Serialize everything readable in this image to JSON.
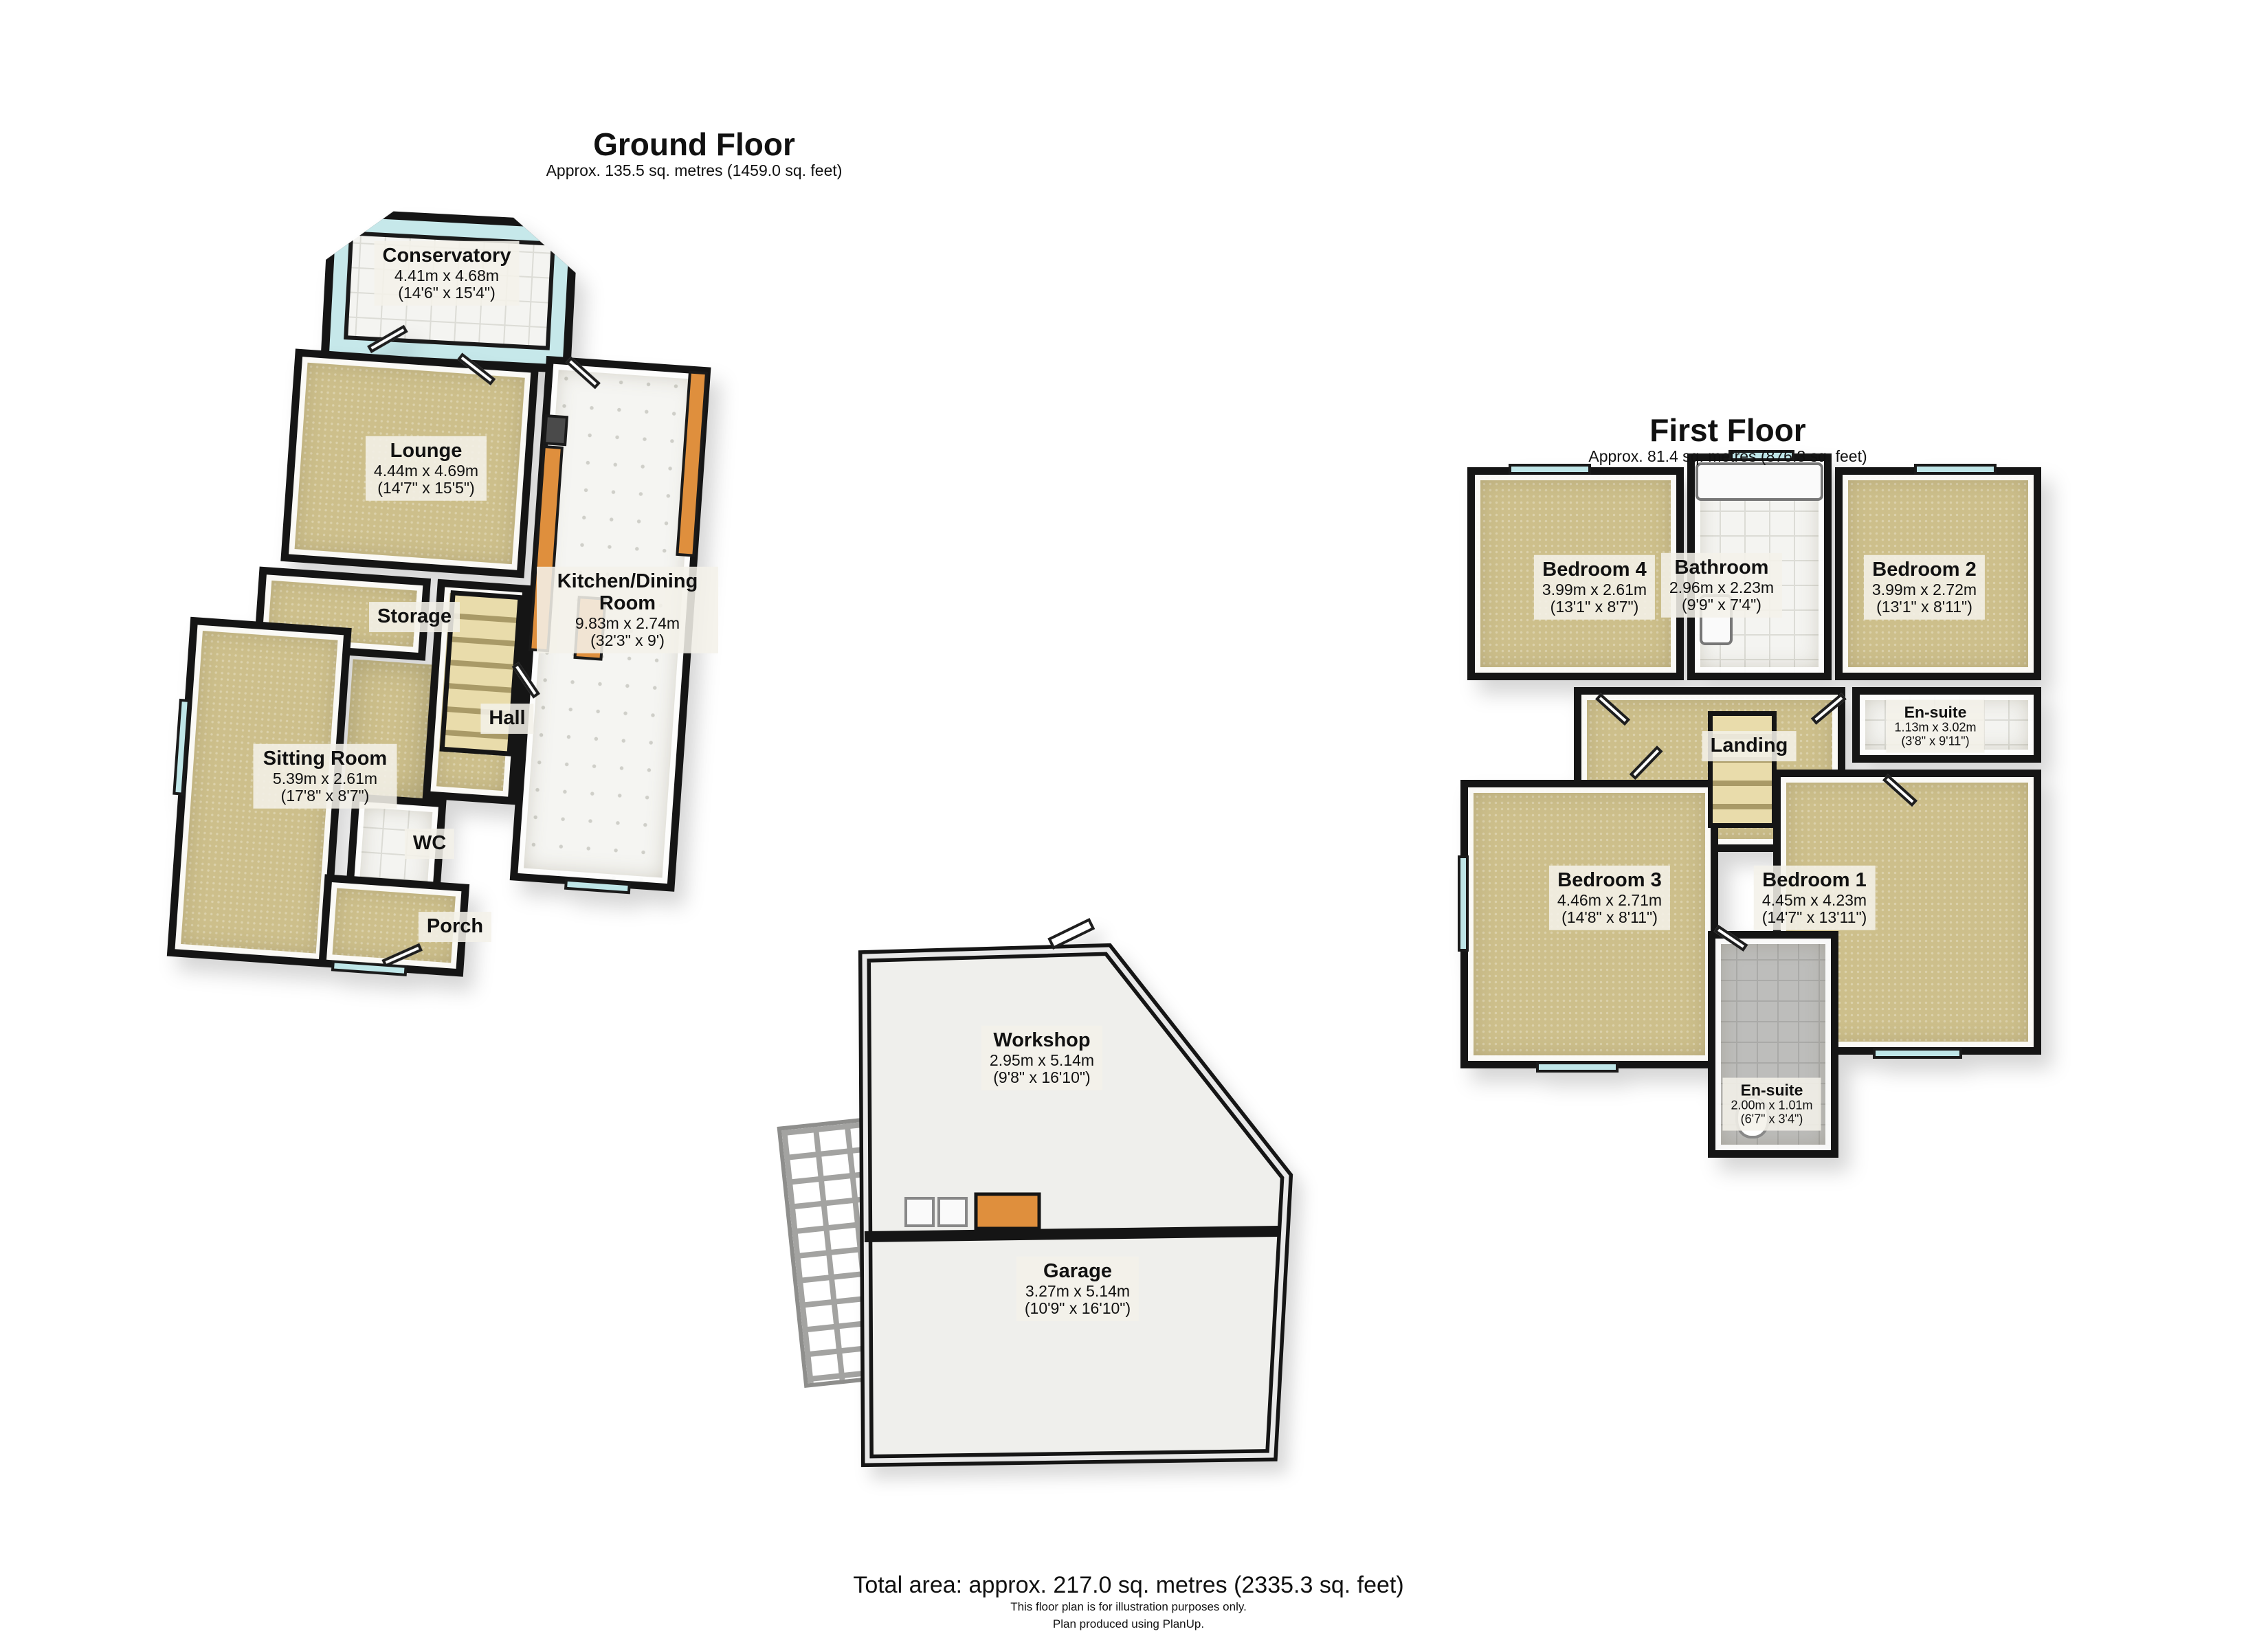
{
  "ground_floor": {
    "title": "Ground Floor",
    "subtitle": "Approx. 135.5 sq. metres (1459.0 sq. feet)",
    "rooms": {
      "conservatory": {
        "name": "Conservatory",
        "dims_m": "4.41m x 4.68m",
        "dims_ft": "(14'6\" x 15'4\")"
      },
      "lounge": {
        "name": "Lounge",
        "dims_m": "4.44m x 4.69m",
        "dims_ft": "(14'7\" x 15'5\")"
      },
      "kitchen": {
        "name": "Kitchen/Dining Room",
        "dims_m": "9.83m x 2.74m",
        "dims_ft": "(32'3\" x 9')"
      },
      "storage": {
        "name": "Storage"
      },
      "hall": {
        "name": "Hall"
      },
      "sitting": {
        "name": "Sitting Room",
        "dims_m": "5.39m x 2.61m",
        "dims_ft": "(17'8\" x 8'7\")"
      },
      "wc": {
        "name": "WC"
      },
      "porch": {
        "name": "Porch"
      }
    }
  },
  "first_floor": {
    "title": "First Floor",
    "subtitle": "Approx. 81.4 sq. metres (876.3 sq. feet)",
    "rooms": {
      "bedroom4": {
        "name": "Bedroom 4",
        "dims_m": "3.99m x 2.61m",
        "dims_ft": "(13'1\" x 8'7\")"
      },
      "bathroom": {
        "name": "Bathroom",
        "dims_m": "2.96m x 2.23m",
        "dims_ft": "(9'9\" x 7'4\")"
      },
      "bedroom2": {
        "name": "Bedroom 2",
        "dims_m": "3.99m x 2.72m",
        "dims_ft": "(13'1\" x 8'11\")"
      },
      "ensuite_top": {
        "name": "En-suite",
        "dims_m": "1.13m x 3.02m",
        "dims_ft": "(3'8\" x 9'11\")"
      },
      "landing": {
        "name": "Landing"
      },
      "bedroom3": {
        "name": "Bedroom 3",
        "dims_m": "4.46m x 2.71m",
        "dims_ft": "(14'8\" x 8'11\")"
      },
      "bedroom1": {
        "name": "Bedroom 1",
        "dims_m": "4.45m x 4.23m",
        "dims_ft": "(14'7\" x 13'11\")"
      },
      "ensuite_bottom": {
        "name": "En-suite",
        "dims_m": "2.00m x 1.01m",
        "dims_ft": "(6'7\" x 3'4\")"
      }
    }
  },
  "outbuilding": {
    "rooms": {
      "workshop": {
        "name": "Workshop",
        "dims_m": "2.95m x 5.14m",
        "dims_ft": "(9'8\" x 16'10\")"
      },
      "garage": {
        "name": "Garage",
        "dims_m": "3.27m x 5.14m",
        "dims_ft": "(10'9\" x 16'10\")"
      }
    }
  },
  "footer": {
    "total": "Total area: approx. 217.0 sq. metres (2335.3 sq. feet)",
    "disclaimer": "This floor plan is for illustration purposes only.",
    "credit": "Plan produced using PlanUp."
  },
  "colors": {
    "floor_beige": "#cdbf8b",
    "wall_black": "#151515",
    "glass_cyan": "#c6e8ea",
    "counter_orange": "#df8f3d"
  }
}
